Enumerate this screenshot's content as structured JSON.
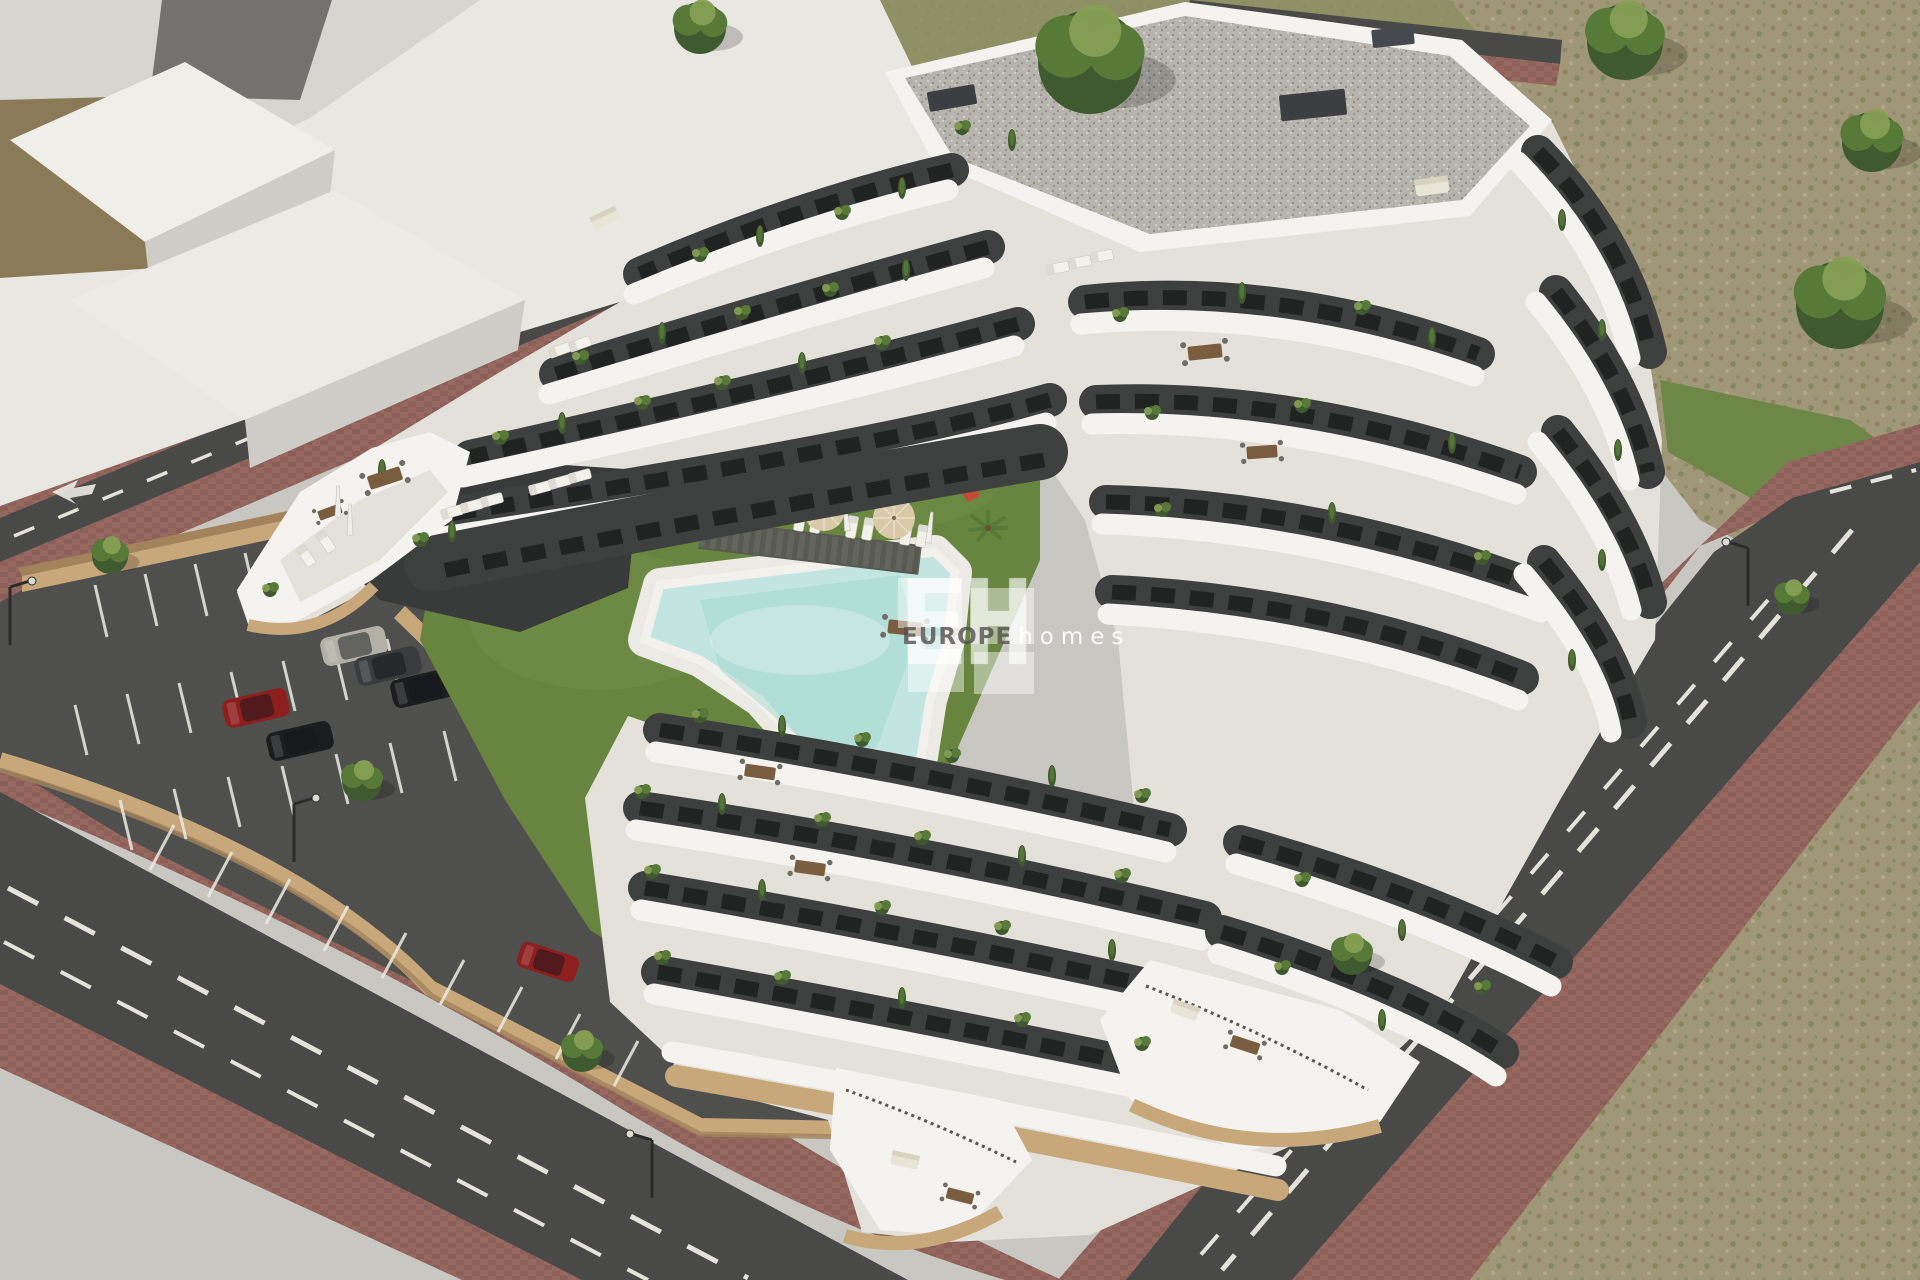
{
  "watermark": {
    "monogram": "EH",
    "brand": "EUROPE",
    "brand_suffix": "homes"
  },
  "scene": {
    "description": "Aerial 3D render of a stepped white apartment complex with wavy balcony bands and rooftop terraces around a communal courtyard with lawn, free-form swimming pool, sun loungers, umbrellas and a playground; striped parking lot with parked cars behind a tan retaining wall; surrounding asphalt roads with dashed markings, red-brick sidewalks, street lamps, trees and dry scrubland; abstract white massing blocks of neighboring buildings in the top-left corner",
    "counts": {
      "parked_cars": 7,
      "sun_umbrellas": 3,
      "street_lamps": 4,
      "swimming_pools": 1,
      "playgrounds": 1
    }
  },
  "palette": {
    "ground": "#c9c7c2",
    "massWhite": "#e9e7e2",
    "massShade": "#cfcdc8",
    "massDark": "#74726e",
    "dirt": "#8a7a57",
    "grassTop": "#8d8f63",
    "scrub": "#a09678",
    "scrubGreen": "#5e7a40",
    "lawn": "#67853f",
    "lawnLight": "#7b9a4f",
    "road": "#494a48",
    "line": "#eceae4",
    "brick": "#96685f",
    "brickDark": "#7c544e",
    "curb": "#b9b7b2",
    "tan": "#c8a77a",
    "tanShade": "#a3835c",
    "parking": "#4f504e",
    "white": "#f4f3ef",
    "bandShade": "#c6c4bd",
    "floor": "#e3e1d9",
    "facade": "#3e403f",
    "windowGlass": "#1d201f",
    "roofGravel": "#b6b4ad",
    "roofEdge": "#8e8c85",
    "pool": "#c2e5e1",
    "poolDeep": "#9fd4cf",
    "deck": "#eceae4",
    "slat": "#63655c",
    "wood": "#7a5c3e",
    "plant": "#587a38",
    "plantDark": "#3f5a2f",
    "plantLight": "#86a054",
    "umbrella": "#d9c9a8",
    "playBlue": "#3a6bc9",
    "playRed": "#c14b3a",
    "carSilver": "#b3b0a6",
    "carBlack": "#1c1d1f",
    "carGray": "#3a3b3d",
    "carRed": "#8e1f1f",
    "carTeal": "#4e7f78",
    "carNavy": "#2b2c34",
    "lampDark": "#2b2b2b"
  }
}
